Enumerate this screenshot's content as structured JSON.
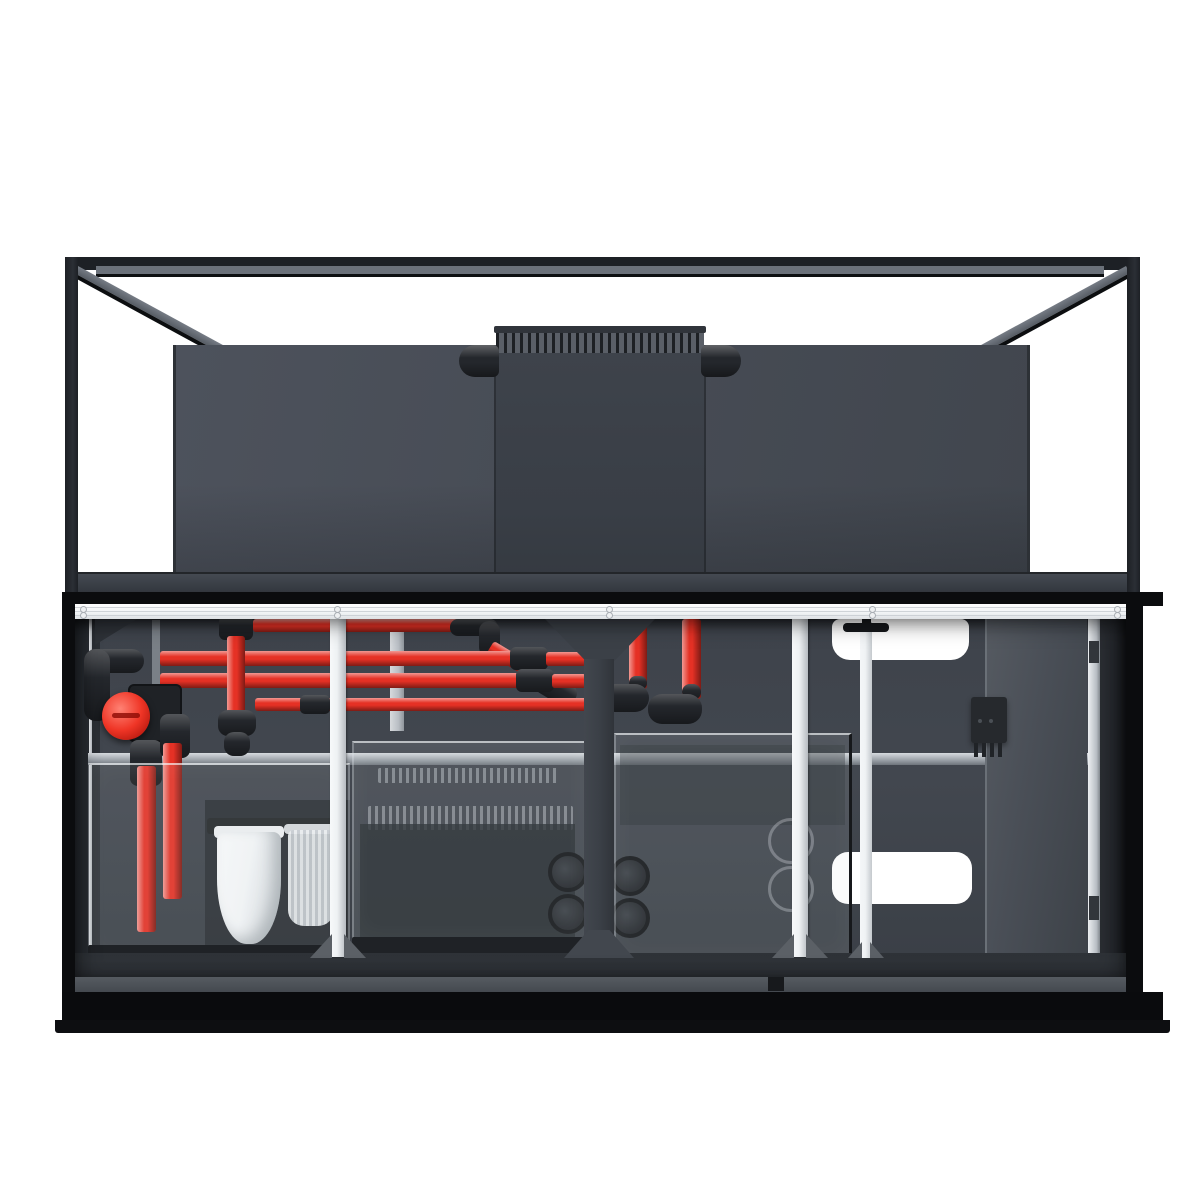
{
  "scene": {
    "subject": "reef-aquarium-system-with-open-equipment-cabinet",
    "text_content": [],
    "parts": [
      "glass-display-tank",
      "tank-frame",
      "tank-back-panel",
      "overflow-box",
      "overflow-comb",
      "overflow-elbow-pipes",
      "cabinet",
      "cabinet-top-rail",
      "red-return-plumbing",
      "gate-valve",
      "filter-sock",
      "filter-cup",
      "sump-left-section",
      "sump-media-section",
      "sump-right-section",
      "bulkhead-fittings",
      "center-divider",
      "support-posts",
      "probe-holder-pole",
      "power-controller-box",
      "open-cabinet-door",
      "base-plinth"
    ]
  },
  "colors": {
    "bg": "#ffffff",
    "frame": "#1d2025",
    "frame_dark": "#0b0c0e",
    "rim_gray": "#6b717a",
    "diag_gray": "#767c85",
    "back_panel": "#4d525c",
    "back_panel_dark": "#41464e",
    "overflow_body": "#3e434b",
    "comb_light": "#5a5f67",
    "comb_dark": "#1d2024",
    "rail_white": "#f2f4f6",
    "rail_groove": "#c6cbd0",
    "interior_bg": "#42474f",
    "wall_dark": "#2c3036",
    "wedge": "#2e3238",
    "alu": "#b9bec4",
    "pipe_red": "#e53125",
    "fitting": "#24272c",
    "knob_red": "#ef3526",
    "glass_fill": "rgba(205,212,220,0.10)",
    "glass_edge": "rgba(224,230,236,0.32)",
    "glass_top": "rgba(246,249,251,0.65)",
    "sock_white": "#f4f6f8",
    "cup_stripe": "#c9ced3",
    "divider": "#3b4047",
    "post_white": "#eef1f3",
    "post_shade": "#b6bbc0",
    "pole_white": "#eff2f4",
    "door_panel": "#4a4f57",
    "door_gap": "#23262b",
    "box_rim": "#1f2226",
    "power_box": "#26292d",
    "floor_strip": "#32363c",
    "base_bar": "#565b61",
    "plinth": "#0a0b0d",
    "cutout": "#ffffff",
    "foot_gray": "#5b6066"
  }
}
